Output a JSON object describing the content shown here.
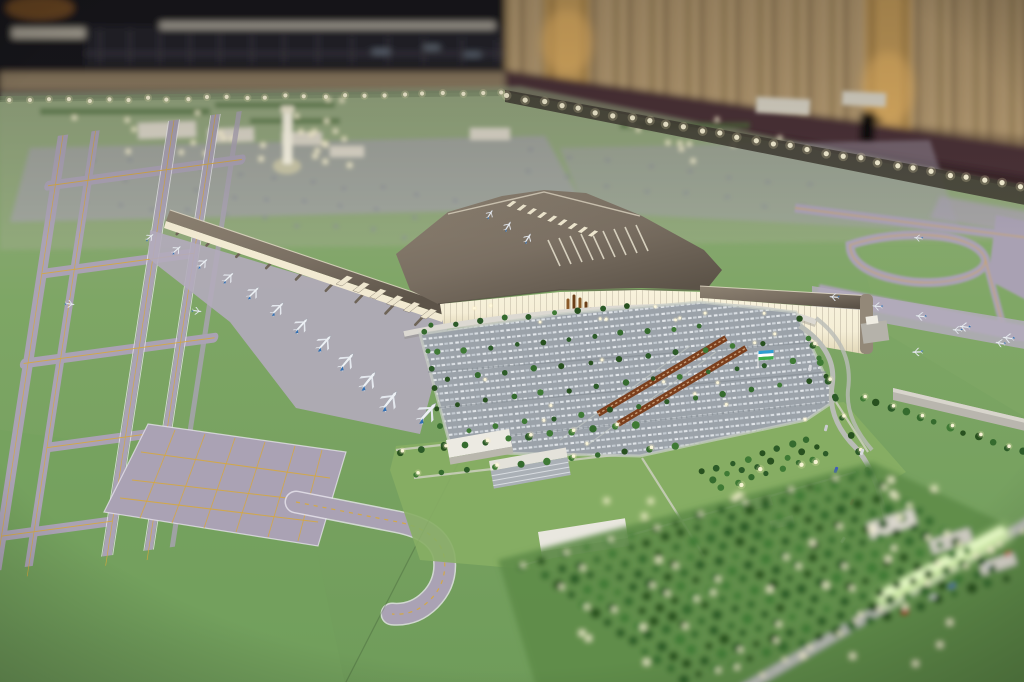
{
  "meta": {
    "description": "Photograph of an architectural scale model of a new international airport displayed on a large table in a dim exhibition hall with beige curtains; the model shows a cross-shaped terminal with glowing glass facades, a long gate pier with blue-tailed aircraft, lavender runways and taxiways, a vast car park with an Uzbekistan flag, tree orchards dotted with miniature lights and a warm-white light string along the table edge."
  },
  "palette": {
    "hall_dark": "#17161a",
    "hall_building": "#24232a",
    "tan_wall": "#8d7b62",
    "curtain": "#b49a73",
    "pillar_gold": "#c89f5c",
    "pillar_glow": "#f0bc6a",
    "floor_maroon": "#4c3037",
    "floor_maroon_dark": "#3a252b",
    "base_green_far": "#94a87f",
    "base_green_mid": "#7ea665",
    "base_green_near": "#6f9c5a",
    "lawn_green": "#87ae64",
    "pavement": "#aaa2b4",
    "pavement_light": "#b3abbb",
    "pavement_edge": "#eceaf2",
    "marking_yellow": "#d7a83c",
    "roof_taupe": "#7a6f62",
    "roof_dark": "#554d43",
    "roof_cream": "#e6deca",
    "glass_warm": "#f5eed6",
    "glass_deep": "#e2d8b8",
    "mullion": "#b9b09c",
    "light_warm": "#fdf3c0",
    "plane_white": "#edf0f4",
    "plane_blue": "#2f6fb4",
    "far_plane_gray": "#8f939b",
    "car_park_bg": "#9ba2a9",
    "car_silver": "#e2e6ea",
    "canopy_brown": "#7c3f1d",
    "canopy_trim": "#d9b892",
    "tree_colors": [
      "#2c5b28",
      "#356b2e",
      "#3f7a35",
      "#28511f"
    ],
    "flag_blue": "#2e9ed2",
    "flag_white": "#ffffff",
    "flag_green": "#3eae49",
    "lit_wall_green": "#d6f7a8",
    "road_gray": "#b9bcb6",
    "building_white": "#e9e7df"
  },
  "scene": {
    "background": {
      "left": "dark exhibition hall with blurred model building and tiny aircraft",
      "right": "beige pleated curtains with two uplit ornamental gold pillars",
      "floor": "dark maroon carpet band behind the model table",
      "wall_lamp": "black cylindrical wall fixture"
    },
    "model": {
      "board": "large green baseboard edged with a string of warm-white miniature lights",
      "runways": "parallel lavender runways and taxiways with yellow centerlines and ladder connectors, left side",
      "remote_apron": "lavender apron with yellow aircraft-stand grid, lower left",
      "pier": "long concourse pier, taupe roof, glowing cream walls, jet bridges and eleven blue-tailed aircraft",
      "terminal": "cross-shaped main terminal with dark taupe roof, ribbed skylight and glowing warm glass facades",
      "control_tower": "glowing white control tower, out of focus, midfield",
      "cargo_buildings": "flat white cargo buildings on far green, out of focus",
      "remote_stands": "rows of tiny grey aircraft on distant aprons, out of focus",
      "car_park": "vast car park of miniature silver cars with tree rows and two brown shade canopies",
      "flag": "small Uzbekistan flag (blue, white, green) standing in the car park",
      "access_roads": "curving grey roads with tiny cars and lit lamp posts, right side",
      "orchard": "dense grid of model trees dotted with warm lights, foreground right, out of focus",
      "lit_wall": "glowing light-green illuminated wall beside the highway, lower right",
      "service_buildings": "small white flat-roofed buildings on lawns south of the car park"
    }
  },
  "generate": {
    "light_strings": [
      {
        "layer": "edge-lights",
        "from": [
          10,
          101
        ],
        "to": [
          502,
          93
        ],
        "count": 26,
        "r": 2.1
      },
      {
        "layer": "edge-lights",
        "from": [
          508,
          96
        ],
        "to": [
          1020,
          187
        ],
        "count": 30,
        "r": 2.6
      }
    ],
    "light_clusters": [
      {
        "layer": "far-lights",
        "x": 60,
        "y": 98,
        "w": 290,
        "h": 58,
        "count": 16,
        "r": 2.0
      },
      {
        "layer": "far-lights",
        "x": 258,
        "y": 120,
        "w": 92,
        "h": 46,
        "count": 12,
        "r": 2.2
      },
      {
        "layer": "far-lights",
        "x": 620,
        "y": 118,
        "w": 170,
        "h": 44,
        "count": 10,
        "r": 2.0
      },
      {
        "layer": "sharp-lights",
        "x": 436,
        "y": 300,
        "w": 372,
        "h": 24,
        "count": 8,
        "r": 1.4
      },
      {
        "layer": "sharp-lights",
        "x": 440,
        "y": 312,
        "w": 380,
        "h": 135,
        "count": 14,
        "r": 1.5
      },
      {
        "layer": "near-lights",
        "x": 540,
        "y": 470,
        "w": 460,
        "h": 200,
        "count": 26,
        "r": 2.6
      }
    ],
    "tree_rows": [
      {
        "layer": "tree-rows",
        "from": [
          430,
          326
        ],
        "to": [
          628,
          306
        ],
        "count": 9,
        "treeR": 2.6
      },
      {
        "layer": "tree-rows",
        "from": [
          438,
          352
        ],
        "to": [
          700,
          326
        ],
        "count": 11,
        "treeR": 2.6
      },
      {
        "layer": "tree-rows",
        "from": [
          448,
          378
        ],
        "to": [
          762,
          344
        ],
        "count": 12,
        "treeR": 2.6
      },
      {
        "layer": "tree-rows",
        "from": [
          458,
          404
        ],
        "to": [
          792,
          362
        ],
        "count": 13,
        "treeR": 2.6
      },
      {
        "layer": "tree-rows",
        "from": [
          468,
          430
        ],
        "to": [
          808,
          382
        ],
        "count": 13,
        "treeR": 2.6
      },
      {
        "layer": "tree-rows",
        "from": [
          424,
          332
        ],
        "to": [
          444,
          446
        ],
        "count": 7,
        "treeR": 2.6
      },
      {
        "layer": "tree-rows",
        "from": [
          800,
          318
        ],
        "to": [
          836,
          396
        ],
        "count": 5,
        "treeR": 2.6
      },
      {
        "layer": "tree-rows",
        "from": [
          400,
          452
        ],
        "to": [
          636,
          424
        ],
        "count": 12,
        "treeR": 3.2,
        "lampEvery": 2
      },
      {
        "layer": "tree-rows",
        "from": [
          416,
          476
        ],
        "to": [
          676,
          446
        ],
        "count": 11,
        "treeR": 3.0,
        "lampEvery": 3
      },
      {
        "layer": "tree-rows",
        "from": [
          862,
          398
        ],
        "to": [
          1022,
          452
        ],
        "count": 12,
        "treeR": 3.2,
        "lampEvery": 2
      },
      {
        "layer": "tree-rows",
        "from": [
          812,
          346
        ],
        "to": [
          866,
          470
        ],
        "count": 8,
        "treeR": 3.0,
        "lampEvery": 2
      },
      {
        "layer": "near-trees",
        "from": [
          520,
          566
        ],
        "to": [
          856,
          474
        ],
        "count": 16,
        "treeR": 3.4,
        "lampEvery": 2
      },
      {
        "layer": "near-trees",
        "from": [
          760,
          676
        ],
        "to": [
          1020,
          532
        ],
        "count": 12,
        "treeR": 0,
        "lampEvery": 1
      }
    ],
    "orchards": [
      {
        "layer": "near-trees",
        "x": 545,
        "y": 575,
        "colDx": 17,
        "colDy": -5.3,
        "rowDx": 12.5,
        "rowDy": 9.5,
        "rows": 12,
        "cols": 20,
        "rMin": 3.4,
        "rMax": 5.6,
        "lightChance": 0.16
      },
      {
        "layer": "tree-rows",
        "x": 702,
        "y": 472,
        "colDx": 15,
        "colDy": -4.6,
        "rowDx": 10,
        "rowDy": 7.5,
        "rows": 3,
        "cols": 8,
        "rMin": 2.6,
        "rMax": 3.6,
        "lightChance": 0.1
      }
    ],
    "plane_rows": [
      {
        "layer": "planes",
        "from": [
          150,
          237
        ],
        "ctrl": [
          286,
          298
        ],
        "to": [
          390,
          400
        ],
        "count": 11,
        "rot0": -40,
        "rot1": -52,
        "s0": 0.5,
        "s1": 1.18
      },
      {
        "layer": "planes",
        "from": [
          834,
          297
        ],
        "ctrl": [
          920,
          315
        ],
        "to": [
          1008,
          338
        ],
        "count": 5,
        "rot0": 185,
        "rot1": 188,
        "s0": 0.5,
        "s1": 0.62
      }
    ],
    "planes": [
      {
        "x": 70,
        "y": 304,
        "s": 0.5,
        "rot": 8
      },
      {
        "x": 197,
        "y": 311,
        "s": 0.5,
        "rot": 8
      },
      {
        "x": 490,
        "y": 214,
        "s": 0.5,
        "rot": -58
      },
      {
        "x": 508,
        "y": 226,
        "s": 0.55,
        "rot": -58
      },
      {
        "x": 528,
        "y": 238,
        "s": 0.55,
        "rot": -58
      },
      {
        "x": 918,
        "y": 238,
        "s": 0.45,
        "rot": 185
      },
      {
        "x": 957,
        "y": 330,
        "s": 0.5,
        "rot": 183
      },
      {
        "x": 1000,
        "y": 343,
        "s": 0.52,
        "rot": 190
      },
      {
        "x": 917,
        "y": 352,
        "s": 0.55,
        "rot": 178
      },
      {
        "x": 428,
        "y": 412,
        "s": 1.26,
        "rot": -48
      }
    ],
    "far_plane_grids": [
      {
        "x": 95,
        "y": 158,
        "colDx": 36,
        "colDy": 4,
        "rowDx": -6,
        "rowDy": 21,
        "rows": 3,
        "cols": 11,
        "s": 0.5,
        "jitter": 3
      },
      {
        "x": 530,
        "y": 150,
        "colDx": 40,
        "colDy": 5,
        "rowDx": -4,
        "rowDy": 24,
        "rows": 2,
        "cols": 8,
        "s": 0.5,
        "jitter": 3
      }
    ],
    "spurs": [
      {
        "layer": "spurs",
        "from": [
          168,
          222
        ],
        "to": [
          444,
          316
        ],
        "count": 9,
        "dir": [
          -0.69,
          0.72
        ],
        "len0": 9,
        "len1": 20
      }
    ],
    "slat_rows": [
      {
        "layer": "slats",
        "x": 506,
        "y": 206,
        "dx": 10.2,
        "dy": 3.7,
        "count": 9,
        "shape": "M0,0 L7,-5.5 L11,-4.2 L4,1.3 Z"
      },
      {
        "layer": "slats",
        "x": 336,
        "y": 284,
        "dx": 16.8,
        "dy": 6.6,
        "count": 6,
        "shape": "M0,0 L11,-8.5 L17,-6.5 L6,2 Z"
      }
    ],
    "cars": [
      {
        "layer": "road-cars",
        "x": 836,
        "y": 470,
        "rot": -70,
        "c": "#3a57c8"
      },
      {
        "layer": "road-cars",
        "x": 852,
        "y": 502,
        "rot": -65,
        "c": "#c83a3a"
      },
      {
        "layer": "road-cars",
        "x": 843,
        "y": 540,
        "rot": -60,
        "c": "#dcdee2"
      },
      {
        "layer": "road-cars",
        "x": 862,
        "y": 452,
        "rot": -70,
        "c": "#d8dade"
      },
      {
        "layer": "road-cars",
        "x": 826,
        "y": 428,
        "rot": -75,
        "c": "#caccd0"
      },
      {
        "layer": "road-cars",
        "x": 810,
        "y": 368,
        "rot": -80,
        "c": "#d8dade"
      },
      {
        "layer": "near-cars",
        "x": 905,
        "y": 612,
        "rot": -30,
        "c": "#cf3d35"
      },
      {
        "layer": "near-cars",
        "x": 952,
        "y": 586,
        "rot": -30,
        "c": "#3a57c8"
      },
      {
        "layer": "near-cars",
        "x": 988,
        "y": 566,
        "rot": -30,
        "c": "#dcdee2"
      },
      {
        "layer": "near-cars",
        "x": 933,
        "y": 597,
        "rot": -30,
        "c": "#d8dade"
      },
      {
        "layer": "near-cars",
        "x": 1008,
        "y": 554,
        "rot": -30,
        "c": "#cf3d35"
      }
    ]
  }
}
